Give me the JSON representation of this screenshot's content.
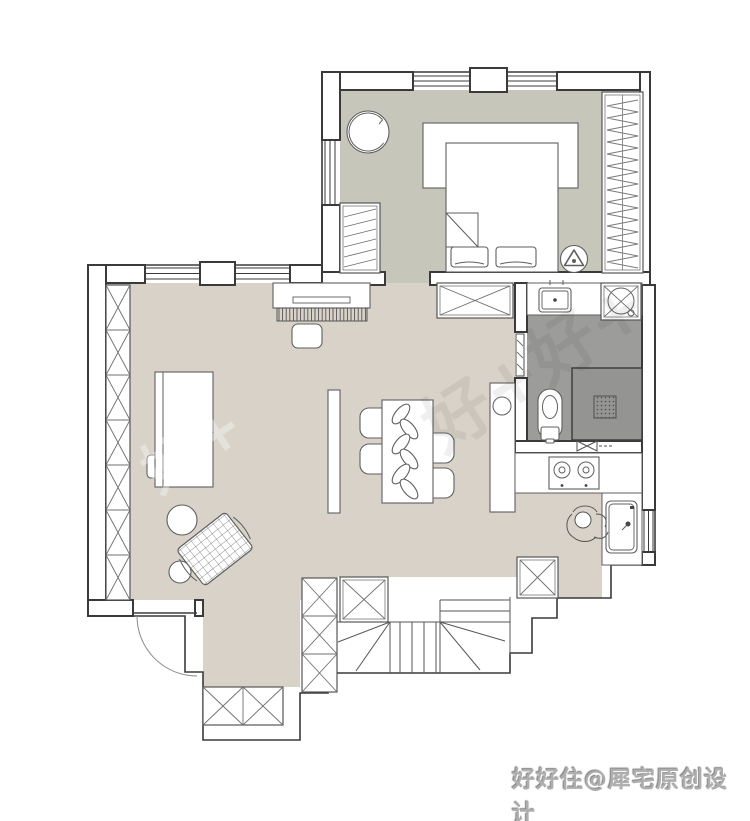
{
  "watermark": {
    "diagonal": "好+好+",
    "diagonal_faint": "好+",
    "credit": "好好住@犀宅原创设计"
  },
  "palette": {
    "bedroom_floor": "#c6c6ba",
    "living_floor": "#d8d2c8",
    "bathroom_floor": "#9c9c9b",
    "shower_floor": "#949492",
    "wall_line": "#3a3a3a",
    "furniture_line": "#5f5f5f",
    "watermark_ink": "#2e2e2e",
    "credit_text_color": "#aeaeae"
  },
  "floors": [
    {
      "name": "bedroom",
      "color": "#c6c6ba"
    },
    {
      "name": "living-dining-entry",
      "color": "#d8d2c8"
    },
    {
      "name": "bathroom",
      "color": "#9c9c9b"
    },
    {
      "name": "shower",
      "color": "#949492"
    }
  ],
  "furniture_icons": [
    "double-bed",
    "pillows",
    "headboard-platform",
    "hanging-wardrobe",
    "small-wardrobe",
    "round-swivel-chair",
    "ceiling-fan",
    "piano",
    "piano-bench",
    "desk",
    "desk-chair",
    "storage-column",
    "plaid-armchair",
    "pouf-large",
    "pouf-small",
    "screen-partition",
    "dining-table",
    "dining-chair",
    "leaf-decor",
    "vanity-counter",
    "basin",
    "washbasin",
    "washing-machine",
    "toilet",
    "shower-enclosure",
    "floor-drain",
    "bathroom-sliding-door",
    "gas-stove",
    "kitchen-sink",
    "person-figure",
    "refrigerator-box",
    "shoe-cabinet",
    "entry-door",
    "stairs"
  ]
}
